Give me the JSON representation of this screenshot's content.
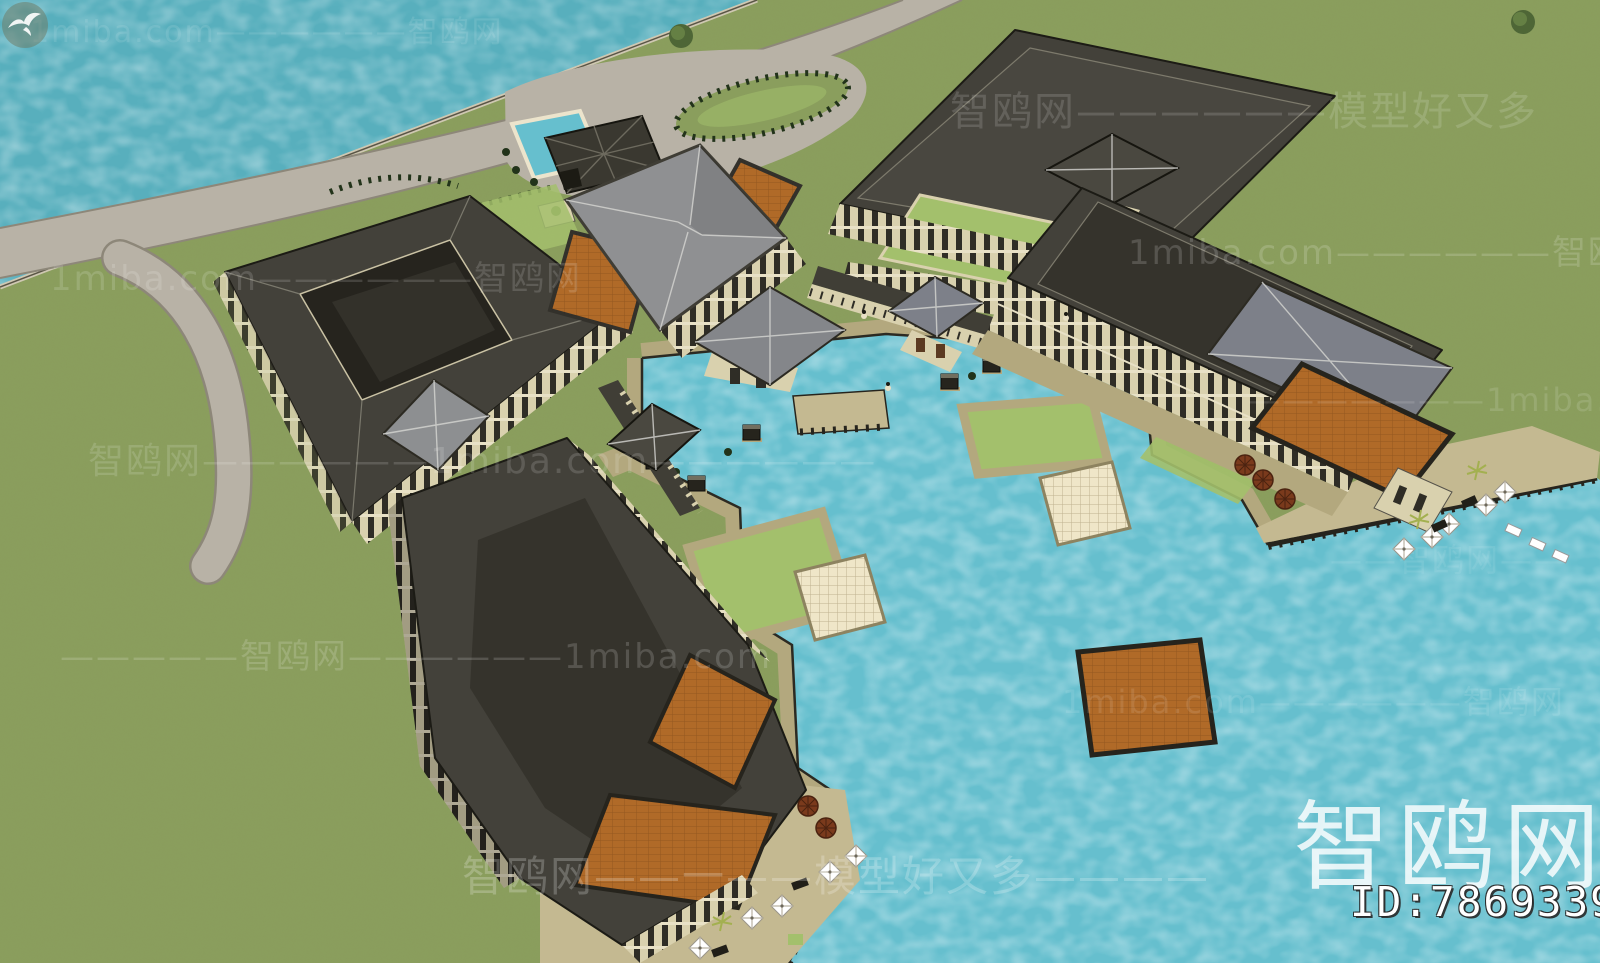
{
  "watermarks": {
    "tiles": [
      {
        "text": "1miba.com——————智鸥网"
      },
      {
        "text": "智鸥网——————模型好又多"
      },
      {
        "text": "1miba.com——————智鸥网———"
      },
      {
        "text": "1miba.com——————智鸥网"
      },
      {
        "text": "———————1miba.com"
      },
      {
        "text": "智鸥网——————1miba.com——————"
      },
      {
        "text": "—————智鸥网——————1miba.com"
      },
      {
        "text": "1miba.com——————智鸥网"
      },
      {
        "text": "智鸥网——一——模型好又多————"
      },
      {
        "text": "——智鸥网——"
      }
    ],
    "logo": {
      "text": "智鸥网"
    },
    "logo_icon": "seagull-icon",
    "id": {
      "text": "ID:786933903"
    }
  },
  "colors": {
    "grass": "#8A9E5D",
    "lawn": "#A3C06C",
    "sea": "#58AFBD",
    "pool": "#66BFCE",
    "road": "#B8B2A6",
    "road_edge": "#8D8779",
    "walkway": "#B3A87E",
    "walkway_edge": "#6E6650",
    "deck": "#C4B991",
    "roof_dark": "#43413A",
    "roof_flat": "#35332C",
    "roof_gray": "#8F9092",
    "roof_slate": "#7D8089",
    "terracotta": "#B06A28",
    "wall_cream": "#D9D1AE",
    "window_dark": "#2F2D26",
    "tile": "#EFE6C8",
    "hedge": "#22331A",
    "pier": "#26241D",
    "watermark": "#FFFFFF"
  }
}
